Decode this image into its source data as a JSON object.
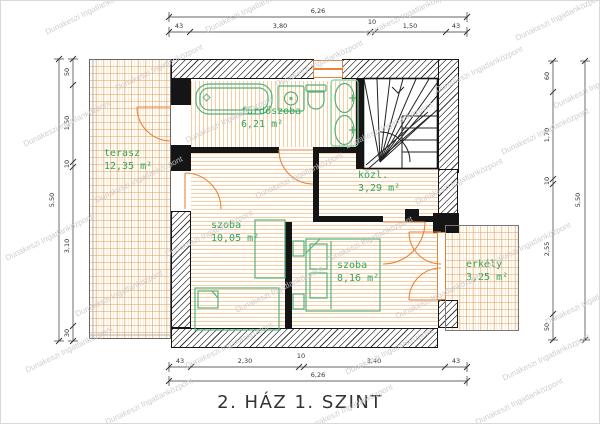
{
  "title": "2. HÁZ 1. SZINT",
  "watermark": {
    "text": "Dunakeszi Ingatlanközpont"
  },
  "rooms": {
    "terasz": {
      "name": "terasz",
      "area": "12,35 m²"
    },
    "furdoszoba": {
      "name": "fürdőszoba",
      "area": "6,21 m²"
    },
    "kozl": {
      "name": "közl.",
      "area": "3,29 m²"
    },
    "szoba1": {
      "name": "szoba",
      "area": "10,05 m²"
    },
    "szoba2": {
      "name": "szoba",
      "area": "8,16 m²"
    },
    "erkely": {
      "name": "erkély",
      "area": "3,25 m²"
    }
  },
  "dimensions": {
    "top": {
      "total": "6,26",
      "parts": [
        "43",
        "3,80",
        "10",
        "1,50",
        "43"
      ]
    },
    "bottom": {
      "total": "6,26",
      "parts": [
        "43",
        "2,30",
        "10",
        "3,40",
        "43"
      ]
    },
    "left": {
      "total": "5,50",
      "parts": [
        "50",
        "1,50",
        "10",
        "3,10",
        "30"
      ]
    },
    "right": {
      "total": "5,50",
      "parts": [
        "60",
        "1,70",
        "10",
        "2,55",
        "50"
      ]
    }
  },
  "colors": {
    "room_label": "#2fa757",
    "furniture": "#53b377",
    "door": "#e8833a",
    "floor_line": "#edb98a",
    "wall": "#151515",
    "dimension": "#333333",
    "watermark": "#c9c9c9"
  }
}
